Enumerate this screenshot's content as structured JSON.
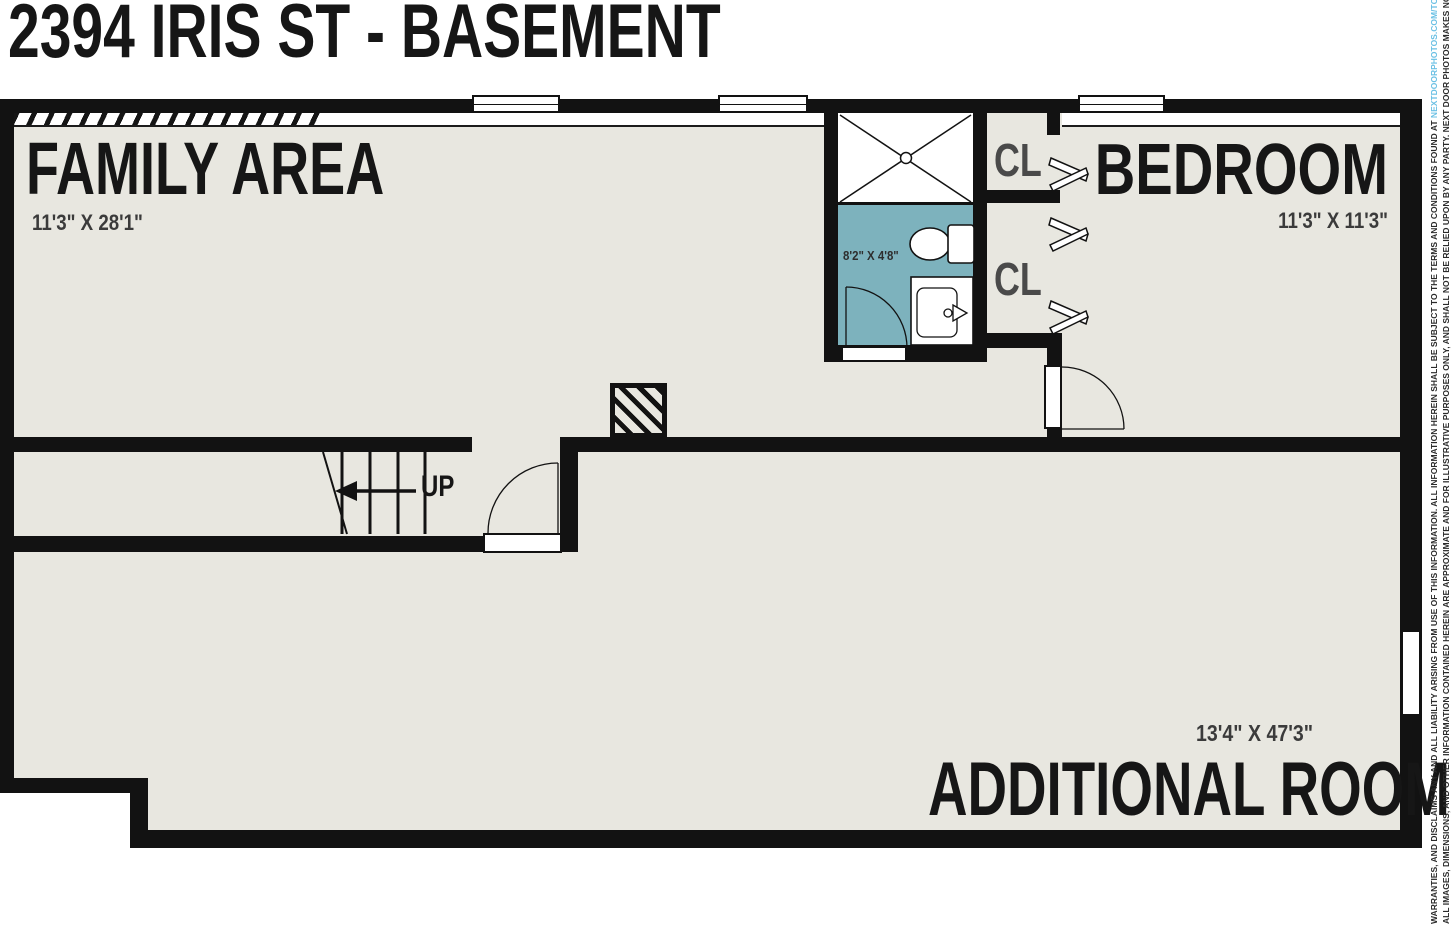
{
  "title": "2394 IRIS ST - BASEMENT",
  "rooms": {
    "family": {
      "name": "FAMILY AREA",
      "dims": "11'3\" X 28'1\""
    },
    "bedroom": {
      "name": "BEDROOM",
      "dims": "11'3\" X 11'3\""
    },
    "additional": {
      "name": "ADDITIONAL ROOM",
      "dims": "13'4\" X 47'3\""
    },
    "bathroom": {
      "dims": "8'2\" X 4'8\""
    },
    "closet_top": {
      "label": "CL"
    },
    "closet_bottom": {
      "label": "CL"
    }
  },
  "stairs": {
    "direction_label": "UP"
  },
  "disclaimer": {
    "line2": "WARRANTIES, AND DISCLAIMS ANY AND ALL LIABILITY ARISING FROM USE OF THIS INFORMATION. ALL INFORMATION HEREIN SHALL BE SUBJECT TO THE TERMS AND CONDITIONS FOUND AT ",
    "link": "NEXTDOORPHOTOS.COM/TC.",
    "line1": "ALL IMAGES, DIMENSIONS, AND OTHER INFORMATION CONTAINED HEREIN ARE APPROXIMATE AND FOR ILLUSTRATIVE PURPOSES ONLY, AND SHALL NOT BE RELIED UPON BY ANY PARTY. NEXT DOOR PHOTOS MAKES NO REPRESENTATIONS OR"
  },
  "colors": {
    "wall": "#121212",
    "floor": "#e8e7e0",
    "bathroom_floor": "#7db2bd",
    "link_blue": "#6ac0e4",
    "label_text": "#161616",
    "dim_text": "#3b3b3b"
  }
}
